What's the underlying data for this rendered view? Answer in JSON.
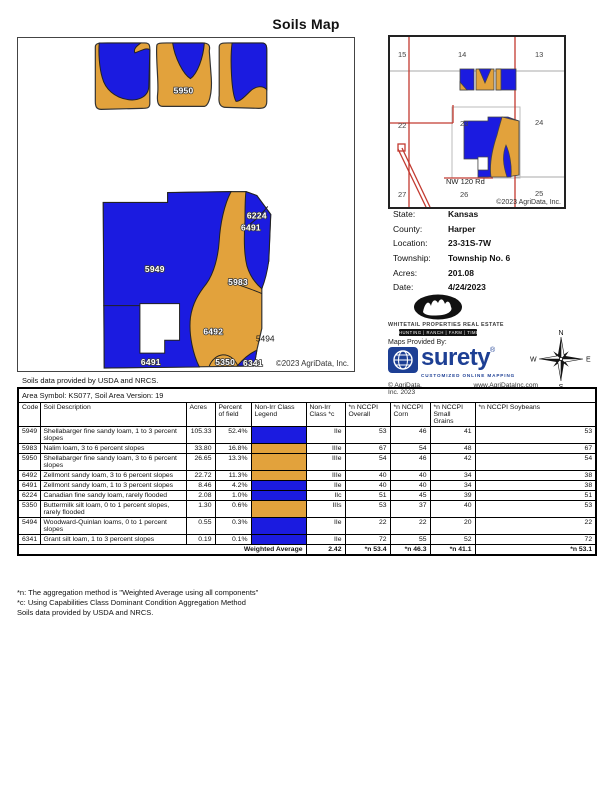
{
  "title": "Soils Map",
  "colors": {
    "soil_blue": "#1b1be0",
    "soil_orange": "#e2a23c",
    "road_red": "#c23a30",
    "surety_blue": "#1d3f94"
  },
  "main_map": {
    "labels": [
      "5950",
      "5949",
      "5983",
      "6492",
      "6224",
      "6491",
      "5494",
      "6491",
      "5350",
      "6341"
    ],
    "copyright": "©2023 AgriData, Inc."
  },
  "locator_map": {
    "sections": [
      "15",
      "14",
      "13",
      "22",
      "23",
      "24",
      "27",
      "26",
      "25"
    ],
    "road": "NW 120 Rd",
    "copyright": "©2023 AgriData, Inc."
  },
  "info": {
    "rows": [
      {
        "label": "State:",
        "value": "Kansas"
      },
      {
        "label": "County:",
        "value": "Harper"
      },
      {
        "label": "Location:",
        "value": "23-31S-7W"
      },
      {
        "label": "Township:",
        "value": "Township No. 6"
      },
      {
        "label": "Acres:",
        "value": "201.08"
      },
      {
        "label": "Date:",
        "value": "4/24/2023"
      }
    ]
  },
  "branding": {
    "whitetail_name": "Whitetail Properties Real Estate",
    "whitetail_tagline": "HUNTING  |  RANCH  |  FARM  |  TIMBER",
    "maps_provided_by": "Maps Provided By:",
    "surety_word": "surety",
    "surety_reg": "®",
    "surety_tagline": "CUSTOMIZED ONLINE MAPPING",
    "agridata_copyright": "© AgriData, Inc. 2023",
    "agridata_url": "www.AgriDataInc.com",
    "compass": {
      "n": "N",
      "s": "S",
      "e": "E",
      "w": "W"
    }
  },
  "soils_note_top": "Soils data provided by USDA and NRCS.",
  "table": {
    "area_symbol": "Area Symbol: KS077, Soil Area Version: 19",
    "headers": [
      "Code",
      "Soil Description",
      "Acres",
      "Percent of field",
      "Non-Irr Class Legend",
      "Non-Irr Class *c",
      "*n NCCPI Overall",
      "*n NCCPI Corn",
      "*n NCCPI Small Grains",
      "*n NCCPI Soybeans"
    ],
    "rows": [
      {
        "code": "5949",
        "description": "Shellabarger fine sandy loam, 1 to 3 percent slopes",
        "acres": "105.33",
        "percent": "52.4%",
        "legend": "blue",
        "class": "IIe",
        "overall": "53",
        "corn": "46",
        "small_grains": "41",
        "soybeans": "53"
      },
      {
        "code": "5983",
        "description": "Nalim loam, 3 to 6 percent slopes",
        "acres": "33.80",
        "percent": "16.8%",
        "legend": "orange",
        "class": "IIIe",
        "overall": "67",
        "corn": "54",
        "small_grains": "48",
        "soybeans": "67"
      },
      {
        "code": "5950",
        "description": "Shellabarger fine sandy loam, 3 to 6 percent slopes",
        "acres": "26.65",
        "percent": "13.3%",
        "legend": "orange",
        "class": "IIIe",
        "overall": "54",
        "corn": "46",
        "small_grains": "42",
        "soybeans": "54"
      },
      {
        "code": "6492",
        "description": "Zellmont sandy loam, 3 to 6 percent slopes",
        "acres": "22.72",
        "percent": "11.3%",
        "legend": "orange",
        "class": "IIIe",
        "overall": "40",
        "corn": "40",
        "small_grains": "34",
        "soybeans": "38"
      },
      {
        "code": "6491",
        "description": "Zellmont sandy loam, 1 to 3 percent slopes",
        "acres": "8.46",
        "percent": "4.2%",
        "legend": "blue",
        "class": "IIe",
        "overall": "40",
        "corn": "40",
        "small_grains": "34",
        "soybeans": "38"
      },
      {
        "code": "6224",
        "description": "Canadian fine sandy loam, rarely flooded",
        "acres": "2.08",
        "percent": "1.0%",
        "legend": "blue",
        "class": "IIc",
        "overall": "51",
        "corn": "45",
        "small_grains": "39",
        "soybeans": "51"
      },
      {
        "code": "5350",
        "description": "Buttermilk silt loam, 0 to 1 percent slopes, rarely flooded",
        "acres": "1.30",
        "percent": "0.6%",
        "legend": "orange",
        "class": "IIIs",
        "overall": "53",
        "corn": "37",
        "small_grains": "40",
        "soybeans": "53"
      },
      {
        "code": "5494",
        "description": "Woodward-Quinlan loams, 0 to 1 percent slopes",
        "acres": "0.55",
        "percent": "0.3%",
        "legend": "blue",
        "class": "IIe",
        "overall": "22",
        "corn": "22",
        "small_grains": "20",
        "soybeans": "22"
      },
      {
        "code": "6341",
        "description": "Grant silt loam, 1 to 3 percent slopes",
        "acres": "0.19",
        "percent": "0.1%",
        "legend": "blue",
        "class": "IIe",
        "overall": "72",
        "corn": "55",
        "small_grains": "52",
        "soybeans": "72"
      }
    ],
    "weighted_average": {
      "label": "Weighted Average",
      "class": "2.42",
      "overall": "*n 53.4",
      "corn": "*n 46.3",
      "small_grains": "*n 41.1",
      "soybeans": "*n 53.1"
    }
  },
  "footnotes": [
    "*n: The aggregation method is \"Weighted Average using all components\"",
    "*c: Using Capabilities Class Dominant Condition Aggregation Method",
    "Soils data provided by USDA and NRCS."
  ]
}
